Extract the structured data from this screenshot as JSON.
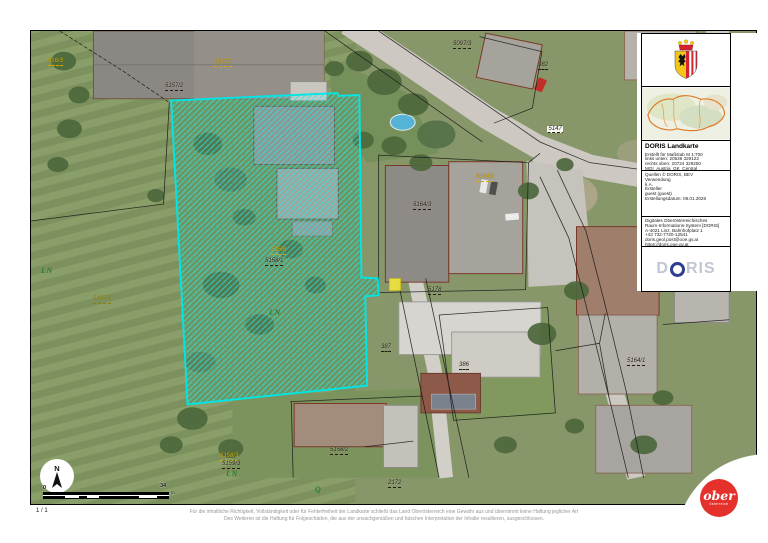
{
  "map": {
    "north_label": "N",
    "page_indicator": "1 / 1",
    "highlight_color": "#00e5e5",
    "scale_bar": {
      "start": "0",
      "end": "34",
      "unit": "m"
    },
    "labels": [
      {
        "text": "916/3",
        "x": 48,
        "y": 58,
        "cls": "yellow",
        "u": true
      },
      {
        "text": "1157/2",
        "x": 214,
        "y": 59,
        "cls": "yellow",
        "u": true
      },
      {
        "text": "5157/2",
        "x": 165,
        "y": 83,
        "cls": "dark",
        "u": true
      },
      {
        "text": "5097/3",
        "x": 453,
        "y": 41,
        "cls": "dark",
        "u": true
      },
      {
        "text": "382",
        "x": 538,
        "y": 62,
        "cls": "dark",
        "u": true
      },
      {
        "text": "5147",
        "x": 547,
        "y": 126,
        "cls": "dark",
        "u": true,
        "halo": true
      },
      {
        "text": "5164/2",
        "x": 476,
        "y": 174,
        "cls": "yellow",
        "u": true
      },
      {
        "text": "5164/3",
        "x": 413,
        "y": 202,
        "cls": "dark",
        "u": true
      },
      {
        "text": "5178",
        "x": 428,
        "y": 287,
        "cls": "dark",
        "u": true
      },
      {
        "text": "5157/1",
        "x": 93,
        "y": 296,
        "cls": "olive",
        "u": true
      },
      {
        "text": "515/8",
        "x": 271,
        "y": 247,
        "cls": "yellow",
        "u": true
      },
      {
        "text": "5158/1",
        "x": 265,
        "y": 258,
        "cls": "dark",
        "u": true
      },
      {
        "text": "LN",
        "x": 41,
        "y": 268,
        "cls": "green"
      },
      {
        "text": "LN",
        "x": 269,
        "y": 310,
        "cls": "green"
      },
      {
        "text": "387",
        "x": 381,
        "y": 344,
        "cls": "dark",
        "u": true
      },
      {
        "text": "386",
        "x": 459,
        "y": 362,
        "cls": "dark",
        "u": true
      },
      {
        "text": "5164/1",
        "x": 627,
        "y": 358,
        "cls": "dark",
        "u": true
      },
      {
        "text": "5158/2",
        "x": 330,
        "y": 447,
        "cls": "dark",
        "u": true
      },
      {
        "text": "5158/3",
        "x": 220,
        "y": 453,
        "cls": "yellow",
        "u": true
      },
      {
        "text": "5159/3",
        "x": 222,
        "y": 461,
        "cls": "dark",
        "u": true
      },
      {
        "text": "LN",
        "x": 226,
        "y": 471,
        "cls": "green"
      },
      {
        "text": "Q",
        "x": 315,
        "y": 487,
        "cls": "green"
      },
      {
        "text": "2172",
        "x": 388,
        "y": 480,
        "cls": "dark",
        "u": true
      }
    ]
  },
  "panel": {
    "title": "DORIS Landkarte",
    "meta": [
      "Erstellt für Maßstab M 1:700",
      "links unten: 20536 329122",
      "rechts oben: 20724 329250",
      "MGI_Austria_GK_Central"
    ],
    "source": [
      "Quellen © DORIS, BEV",
      "Verwendung",
      "k.A.",
      "Ersteller",
      "guest (guest)",
      "Erstellungsdatum: 08.01.2026"
    ],
    "contact": [
      "Digitales Oberösterreichisches",
      "Raum-Informations-System [DORIS]",
      "A-4021 Linz, Bahnhofplatz 1",
      "+43 732-7720-12541",
      "doris.geol.post@ooe.gv.at",
      "https://doris.ooe.gv.at"
    ],
    "doris_logo": {
      "left": "D",
      "right": "RIS"
    }
  },
  "footer": {
    "line1": "Für die inhaltliche Richtigkeit, Vollständigkeit oder für Fehlerfreiheit der Landkarte schließt das Land Oberösterreich eine Gewähr aus und übernimmt keine Haftung jeglicher Art",
    "line2": "Des Weiteren ist die Haftung für Folgeschäden, die aus der unsachgemäßen und falschen Interpretation der Inhalte resultieren, ausgeschlossen."
  },
  "ober_logo": {
    "line1": "ober",
    "line2": "österreich"
  },
  "colors": {
    "highlight": "#00e5e5",
    "logo_red": "#e4312b",
    "doris_blue": "#2e3f8f",
    "boundary_orange": "#e07a28",
    "label_yellow": "#cfa90a",
    "label_green": "#2f7d2f"
  }
}
